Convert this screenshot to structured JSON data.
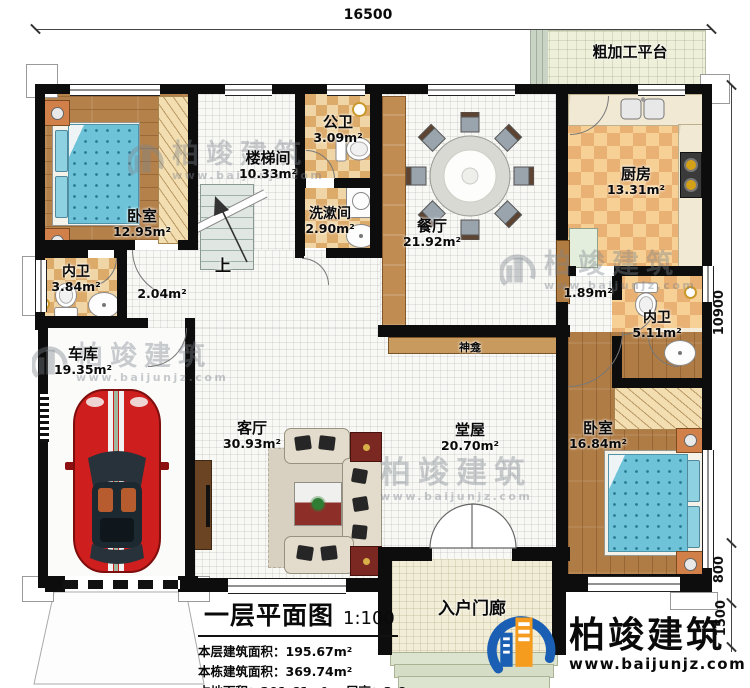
{
  "plan": {
    "dimensions": {
      "top": "16500",
      "side": "10900",
      "side_lower": "800",
      "side_porch": "1500"
    },
    "stairs_up": "上",
    "rooms": {
      "bedroom1": {
        "name": "卧室",
        "area": "12.95m²"
      },
      "stairwell": {
        "name": "楼梯间",
        "area": "10.33m²"
      },
      "public_bath": {
        "name": "公卫",
        "area": "3.09m²"
      },
      "washroom": {
        "name": "洗漱间",
        "area": "2.90m²"
      },
      "dining": {
        "name": "餐厅",
        "area": "21.92m²"
      },
      "kitchen": {
        "name": "厨房",
        "area": "13.31m²"
      },
      "platform": {
        "name": "粗加工平台"
      },
      "bath_left": {
        "name": "内卫",
        "area": "3.84m²"
      },
      "hall_small": {
        "area": "2.04m²"
      },
      "garage": {
        "name": "车库",
        "area": "19.35m²"
      },
      "living": {
        "name": "客厅",
        "area": "30.93m²"
      },
      "main_hall": {
        "name": "堂屋",
        "area": "20.70m²"
      },
      "shrine": {
        "name": "神龛"
      },
      "corridor": {
        "area": "1.89m²"
      },
      "bath_right": {
        "name": "内卫",
        "area": "5.11m²"
      },
      "bedroom2": {
        "name": "卧室",
        "area": "16.84m²"
      },
      "porch": {
        "name": "入户门廊"
      }
    }
  },
  "title_block": {
    "title": "一层平面图",
    "scale": "1:100",
    "floor_area_label": "本层建筑面积：",
    "floor_area": "195.67m²",
    "total_area_label": "本栋建筑面积：",
    "total_area": "369.74m²",
    "land_area_label": "占地面积：",
    "land_area": "201.61m²",
    "height_label": "层高：",
    "height": "3.6m"
  },
  "brand": {
    "name": "柏竣建筑",
    "url": "www.baijunjz.com"
  },
  "watermark": {
    "text": "柏竣建筑",
    "url": "www.baijunjz.com"
  },
  "colors": {
    "wall": "#0d0d0d",
    "wood": "#b5814a",
    "tile_tan": "#dcaa69",
    "accent_blue": "#1a5fb4",
    "accent_orange": "#f59b1e",
    "car_red": "#cf1e1e"
  }
}
